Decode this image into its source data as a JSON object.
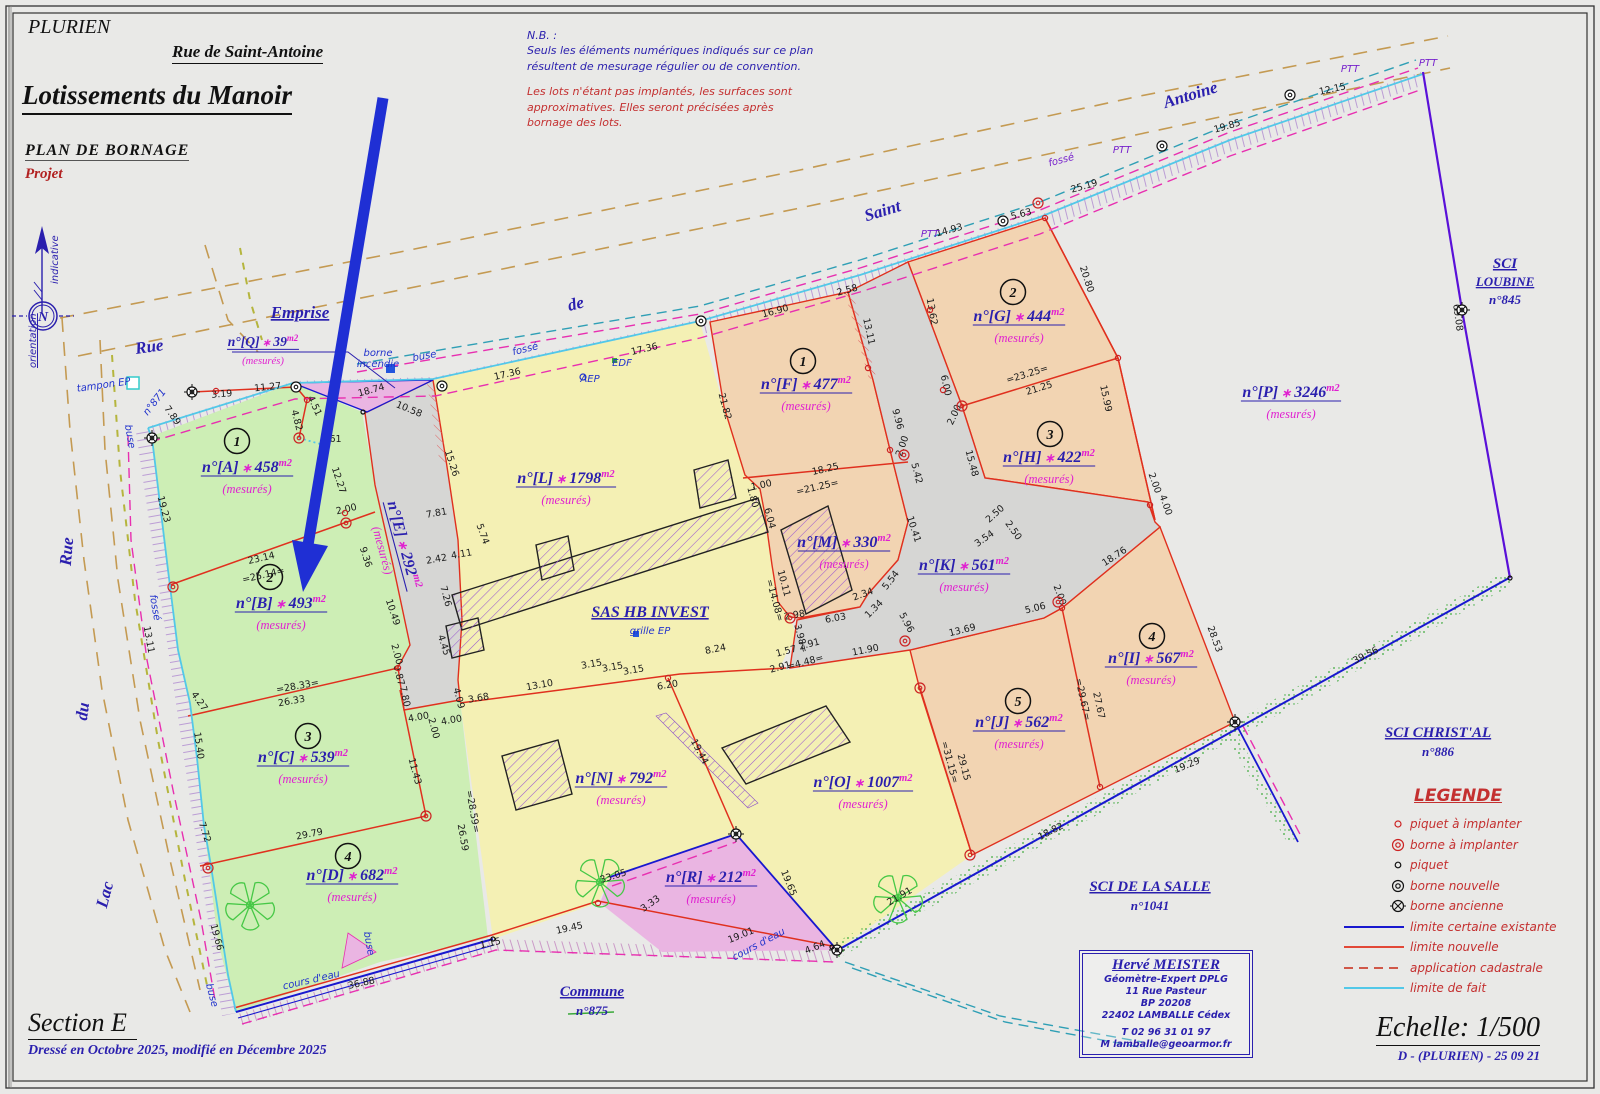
{
  "header": {
    "commune": "PLURIEN",
    "street_title": "Rue de Saint-Antoine",
    "title": "Lotissements du Manoir",
    "subtitle": "PLAN DE BORNAGE",
    "status": "Projet"
  },
  "notes": {
    "heading": "N.B. :",
    "blue": [
      "Seuls les éléments numériques indiqués sur ce plan",
      "résultent de mesurage régulier ou de convention."
    ],
    "red": [
      "Les lots n'étant pas implantés, les surfaces sont",
      "approximatives. Elles seront précisées après",
      "bornage des lots."
    ]
  },
  "north": {
    "n": "N",
    "indicative": "indicative",
    "orientation": "orientation"
  },
  "footer": {
    "section": "Section E",
    "drafted": "Dressé en Octobre 2025, modifié en Décembre 2025",
    "scale": "Echelle: 1/500",
    "ref": "D - (PLURIEN) - 25 09 21"
  },
  "surveyor": {
    "name": "Hervé MEISTER",
    "lines": [
      "Géomètre-Expert DPLG",
      "11 Rue Pasteur",
      "BP 20208",
      "22402 LAMBALLE Cédex",
      "T 02 96 31 01 97",
      "M lamballe@geoarmor.fr"
    ]
  },
  "legend": {
    "title": "LEGENDE",
    "items": [
      {
        "symbol": "piquet-a-implanter",
        "label": "piquet à implanter"
      },
      {
        "symbol": "borne-a-implanter",
        "label": "borne à implanter"
      },
      {
        "symbol": "piquet",
        "label": "piquet"
      },
      {
        "symbol": "borne-nouvelle",
        "label": "borne nouvelle"
      },
      {
        "symbol": "borne-ancienne",
        "label": "borne ancienne"
      },
      {
        "symbol": "limite-certaine-existante",
        "label": "limite certaine existante"
      },
      {
        "symbol": "limite-nouvelle",
        "label": "limite nouvelle"
      },
      {
        "symbol": "application-cadastrale",
        "label": "application cadastrale"
      },
      {
        "symbol": "limite-de-fait",
        "label": "limite de fait"
      }
    ]
  },
  "colors": {
    "accent_blue": "#2a1fae",
    "magenta": "#e020d0",
    "red_line": "#e0301e",
    "blue_line": "#1818cf",
    "cyan_line": "#52c8e8",
    "purple_line": "#5a10d8",
    "green_parcel": "#cdeeb5",
    "yellow_parcel": "#f4f0b4",
    "orange_parcel": "#f2d4b2",
    "pink_parcel": "#eab5e2",
    "road_gray": "#d6d6d4",
    "legend_red": "#c43030",
    "arrow_blue": "#1f2fd4"
  },
  "parcels": [
    {
      "id": "A",
      "name": "n°[A]",
      "area": "458",
      "unit": "m2",
      "note": "(mesurés)",
      "lot": "1",
      "x": 247,
      "y": 472,
      "lot_x": 237,
      "lot_y": 441
    },
    {
      "id": "B",
      "name": "n°[B]",
      "area": "493",
      "unit": "m2",
      "note": "(mesurés)",
      "lot": "2",
      "x": 281,
      "y": 608,
      "lot_x": 270,
      "lot_y": 577
    },
    {
      "id": "C",
      "name": "n°[C]",
      "area": "539",
      "unit": "m2",
      "note": "(mesurés)",
      "lot": "3",
      "x": 303,
      "y": 762,
      "lot_x": 308,
      "lot_y": 736
    },
    {
      "id": "D",
      "name": "n°[D]",
      "area": "682",
      "unit": "m2",
      "note": "(mesurés)",
      "lot": "4",
      "x": 352,
      "y": 880,
      "lot_x": 348,
      "lot_y": 856
    },
    {
      "id": "E",
      "name": "n°[E]",
      "area": "292",
      "unit": "m2",
      "note": "(mesurés)",
      "x": 399,
      "y": 546,
      "angle": 75
    },
    {
      "id": "F",
      "name": "n°[F]",
      "area": "477",
      "unit": "m2",
      "note": "(mesurés)",
      "lot": "1",
      "x": 806,
      "y": 389,
      "lot_x": 803,
      "lot_y": 361
    },
    {
      "id": "G",
      "name": "n°[G]",
      "area": "444",
      "unit": "m2",
      "note": "(mesurés)",
      "lot": "2",
      "x": 1019,
      "y": 321,
      "lot_x": 1013,
      "lot_y": 292
    },
    {
      "id": "H",
      "name": "n°[H]",
      "area": "422",
      "unit": "m2",
      "note": "(mesurés)",
      "lot": "3",
      "x": 1049,
      "y": 462,
      "lot_x": 1050,
      "lot_y": 434
    },
    {
      "id": "I",
      "name": "n°[I]",
      "area": "567",
      "unit": "m2",
      "note": "(mesurés)",
      "lot": "4",
      "x": 1151,
      "y": 663,
      "lot_x": 1152,
      "lot_y": 636
    },
    {
      "id": "J",
      "name": "n°[J]",
      "area": "562",
      "unit": "m2",
      "note": "(mesurés)",
      "lot": "5",
      "x": 1019,
      "y": 727,
      "lot_x": 1018,
      "lot_y": 701
    },
    {
      "id": "K",
      "name": "n°[K]",
      "area": "561",
      "unit": "m2",
      "note": "(mesurés)",
      "x": 964,
      "y": 570
    },
    {
      "id": "L",
      "name": "n°[L]",
      "area": "1798",
      "unit": "m2",
      "note": "(mesurés)",
      "x": 566,
      "y": 483
    },
    {
      "id": "M",
      "name": "n°[M]",
      "area": "330",
      "unit": "m2",
      "note": "(mesurés)",
      "x": 844,
      "y": 547
    },
    {
      "id": "N",
      "name": "n°[N]",
      "area": "792",
      "unit": "m2",
      "note": "(mesurés)",
      "x": 621,
      "y": 783
    },
    {
      "id": "O",
      "name": "n°[O]",
      "area": "1007",
      "unit": "m2",
      "note": "(mesurés)",
      "x": 863,
      "y": 787
    },
    {
      "id": "P",
      "name": "n°[P]",
      "area": "3246",
      "unit": "m2",
      "note": "(mesurés)",
      "x": 1291,
      "y": 397
    },
    {
      "id": "Q",
      "name": "n°[Q]",
      "area": "39",
      "unit": "m2",
      "note": "(mesurés)",
      "x": 263,
      "y": 346,
      "s": 0.85
    },
    {
      "id": "R",
      "name": "n°[R]",
      "area": "212",
      "unit": "m2",
      "note": "(mesurés)",
      "x": 711,
      "y": 882
    }
  ],
  "owners": [
    {
      "x": 1505,
      "y": 268,
      "fs": 15,
      "lh": 18,
      "lines": [
        [
          "SCI",
          1
        ],
        [
          "LOUBINE",
          1
        ],
        [
          "n°845",
          0
        ]
      ]
    },
    {
      "x": 1438,
      "y": 737,
      "fs": 15,
      "lh": 19,
      "lines": [
        [
          "SCI CHRIST'AL",
          1
        ],
        [
          "n°886",
          0
        ]
      ]
    },
    {
      "x": 1150,
      "y": 891,
      "fs": 15,
      "lh": 19,
      "lines": [
        [
          "SCI DE LA SALLE",
          1
        ],
        [
          "n°1041",
          0
        ]
      ]
    },
    {
      "x": 592,
      "y": 996,
      "fs": 15,
      "lh": 19,
      "lines": [
        [
          "Commune",
          1
        ],
        [
          "n°875",
          0
        ]
      ]
    },
    {
      "x": 650,
      "y": 617,
      "fs": 16,
      "lh": 19,
      "lines": [
        [
          "SAS HB INVEST",
          1
        ]
      ]
    }
  ],
  "streets": [
    {
      "t": "Rue",
      "x": 150,
      "y": 352,
      "a": -8
    },
    {
      "t": "de",
      "x": 577,
      "y": 309,
      "a": -14
    },
    {
      "t": "Saint",
      "x": 884,
      "y": 216,
      "a": -17
    },
    {
      "t": "Antoine",
      "x": 1192,
      "y": 100,
      "a": -17
    },
    {
      "t": "Rue",
      "x": 72,
      "y": 552,
      "a": -85
    },
    {
      "t": "du",
      "x": 88,
      "y": 712,
      "a": -83
    },
    {
      "t": "Lac",
      "x": 110,
      "y": 896,
      "a": -75
    },
    {
      "t": "Emprise",
      "x": 300,
      "y": 318,
      "a": 0,
      "u": 1
    }
  ],
  "utilities": [
    {
      "t": "borne",
      "x": 378,
      "y": 356,
      "a": 0,
      "c": "b"
    },
    {
      "t": "incendie",
      "x": 378,
      "y": 367,
      "a": 0,
      "c": "b"
    },
    {
      "t": "buse",
      "x": 425,
      "y": 359,
      "a": -10,
      "c": "b"
    },
    {
      "t": "fossé",
      "x": 526,
      "y": 352,
      "a": -14,
      "c": "b"
    },
    {
      "t": "AEP",
      "x": 590,
      "y": 382,
      "a": 0,
      "c": "b"
    },
    {
      "t": "EDF",
      "x": 622,
      "y": 366,
      "a": 0,
      "c": "b"
    },
    {
      "t": "tampon EP",
      "x": 104,
      "y": 388,
      "a": -8,
      "c": "b"
    },
    {
      "t": "buse",
      "x": 127,
      "y": 437,
      "a": 80,
      "c": "b"
    },
    {
      "t": "fossé",
      "x": 152,
      "y": 608,
      "a": 80,
      "c": "b"
    },
    {
      "t": "buse",
      "x": 209,
      "y": 996,
      "a": 75,
      "c": "b"
    },
    {
      "t": "buse",
      "x": 366,
      "y": 944,
      "a": 80,
      "c": "b"
    },
    {
      "t": "grille EP",
      "x": 650,
      "y": 634,
      "a": 0,
      "c": "b"
    },
    {
      "t": "cours d'eau",
      "x": 312,
      "y": 983,
      "a": -13,
      "c": "b"
    },
    {
      "t": "cours d'eau",
      "x": 760,
      "y": 947,
      "a": -28,
      "c": "b"
    },
    {
      "t": "fossé",
      "x": 1062,
      "y": 163,
      "a": -15,
      "c": "p"
    },
    {
      "t": "PTT",
      "x": 930,
      "y": 237,
      "a": 0,
      "c": "p"
    },
    {
      "t": "PTT",
      "x": 1122,
      "y": 153,
      "a": 0,
      "c": "p"
    },
    {
      "t": "PTT",
      "x": 1350,
      "y": 72,
      "a": 0,
      "c": "p"
    },
    {
      "t": "PTT",
      "x": 1428,
      "y": 66,
      "a": 0,
      "c": "p"
    },
    {
      "t": "n°871",
      "x": 157,
      "y": 404,
      "a": -52,
      "c": "b"
    }
  ],
  "measurements": [
    [
      "18.74",
      372,
      393,
      -15
    ],
    [
      "10.58",
      408,
      412,
      22
    ],
    [
      "17.36",
      508,
      377,
      -13
    ],
    [
      "17.36",
      645,
      352,
      -13
    ],
    [
      "14.93",
      950,
      233,
      -15
    ],
    [
      "5.63",
      1022,
      217,
      -15
    ],
    [
      "25.19",
      1085,
      189,
      -16
    ],
    [
      "19.85",
      1228,
      129,
      -16
    ],
    [
      "12.15",
      1333,
      92,
      -12
    ],
    [
      "69.08",
      1455,
      318,
      82
    ],
    [
      "3.19",
      222,
      397,
      -5
    ],
    [
      "11.27",
      268,
      390,
      -6
    ],
    [
      "4.51",
      312,
      407,
      65
    ],
    [
      "4.82",
      294,
      421,
      75
    ],
    [
      "3.61",
      331,
      442,
      0
    ],
    [
      "7.89",
      170,
      417,
      55
    ],
    [
      "19.23",
      161,
      510,
      75
    ],
    [
      "12.27",
      336,
      481,
      72
    ],
    [
      "15.26",
      449,
      464,
      72
    ],
    [
      "23.14",
      262,
      561,
      -13
    ],
    [
      "=25.14=",
      264,
      578,
      -13
    ],
    [
      "2.00",
      347,
      512,
      -13
    ],
    [
      "9.36",
      363,
      558,
      72
    ],
    [
      "13.11",
      146,
      640,
      80
    ],
    [
      "10.49",
      390,
      613,
      72
    ],
    [
      "2.00",
      394,
      655,
      75
    ],
    [
      "0.87",
      396,
      676,
      75
    ],
    [
      "=28.33=",
      298,
      689,
      -10
    ],
    [
      "26.33",
      292,
      704,
      -10
    ],
    [
      "4.27",
      197,
      703,
      55
    ],
    [
      "15.40",
      196,
      746,
      82
    ],
    [
      "7.80",
      402,
      697,
      78
    ],
    [
      "11.43",
      412,
      772,
      75
    ],
    [
      "2.00",
      431,
      729,
      75
    ],
    [
      "4.00",
      419,
      720,
      -10
    ],
    [
      "4.00",
      452,
      723,
      -10
    ],
    [
      "4.09",
      456,
      699,
      75
    ],
    [
      "3.68",
      479,
      701,
      -10
    ],
    [
      "13.10",
      540,
      688,
      -10
    ],
    [
      "7.72",
      202,
      833,
      72
    ],
    [
      "29.79",
      310,
      837,
      -11
    ],
    [
      "=28.59=",
      470,
      812,
      80
    ],
    [
      "26.59",
      460,
      838,
      80
    ],
    [
      "19.66",
      214,
      938,
      75
    ],
    [
      "36.88",
      362,
      986,
      -12
    ],
    [
      "1.15",
      491,
      946,
      -12
    ],
    [
      "33.05",
      614,
      879,
      -17
    ],
    [
      "3.33",
      652,
      906,
      -35
    ],
    [
      "19.45",
      570,
      931,
      -12
    ],
    [
      "19.01",
      742,
      938,
      -22
    ],
    [
      "7.81",
      437,
      516,
      -10
    ],
    [
      "5.74",
      480,
      535,
      70
    ],
    [
      "2.42",
      437,
      562,
      -10
    ],
    [
      "4.11",
      462,
      557,
      -10
    ],
    [
      "7.26",
      443,
      597,
      75
    ],
    [
      "4.45",
      441,
      646,
      72
    ],
    [
      "21.82",
      722,
      407,
      75
    ],
    [
      "1.00",
      762,
      488,
      -12
    ],
    [
      "1.80",
      750,
      498,
      75
    ],
    [
      "6.04",
      767,
      519,
      75
    ],
    [
      "10.11",
      781,
      584,
      75
    ],
    [
      "=14.08=",
      772,
      601,
      75
    ],
    [
      "2.98",
      795,
      618,
      -10
    ],
    [
      "6.03",
      836,
      621,
      -10
    ],
    [
      "2.34",
      864,
      597,
      -20
    ],
    [
      "1.34",
      876,
      611,
      -45
    ],
    [
      "5.54",
      893,
      582,
      -52
    ],
    [
      "5.96",
      904,
      624,
      62
    ],
    [
      "3.98=",
      798,
      639,
      75
    ],
    [
      "1.57",
      787,
      654,
      -15
    ],
    [
      "2.91",
      810,
      647,
      -15
    ],
    [
      "=4.48=",
      806,
      665,
      -15
    ],
    [
      "2.91",
      781,
      670,
      -15
    ],
    [
      "11.90",
      866,
      653,
      -11
    ],
    [
      "8.24",
      716,
      652,
      -11
    ],
    [
      "3.15",
      592,
      667,
      -10
    ],
    [
      "3.15",
      613,
      670,
      -10
    ],
    [
      "3.15",
      634,
      673,
      -10
    ],
    [
      "6.20",
      668,
      688,
      -10
    ],
    [
      "16.90",
      776,
      314,
      -15
    ],
    [
      "2.58",
      848,
      293,
      -15
    ],
    [
      "13.11",
      866,
      332,
      78
    ],
    [
      "13.62",
      929,
      312,
      80
    ],
    [
      "9.96",
      895,
      420,
      75
    ],
    [
      "2.00",
      905,
      447,
      -70
    ],
    [
      "18.25",
      826,
      472,
      -13
    ],
    [
      "=21.25=",
      818,
      490,
      -13
    ],
    [
      "5.42",
      914,
      474,
      75
    ],
    [
      "15.48",
      969,
      464,
      75
    ],
    [
      "6.00",
      943,
      386,
      78
    ],
    [
      "20.80",
      1084,
      280,
      72
    ],
    [
      "=23.25=",
      1028,
      377,
      -17
    ],
    [
      "21.25",
      1040,
      391,
      -17
    ],
    [
      "2.00",
      957,
      416,
      -65
    ],
    [
      "15.99",
      1103,
      399,
      78
    ],
    [
      "2.00",
      1152,
      484,
      70
    ],
    [
      "4.00",
      1163,
      506,
      70
    ],
    [
      "2.50",
      997,
      516,
      -42
    ],
    [
      "2.50",
      1011,
      532,
      55
    ],
    [
      "3.54",
      986,
      541,
      -35
    ],
    [
      "10.41",
      911,
      530,
      72
    ],
    [
      "18.76",
      1116,
      559,
      -33
    ],
    [
      "13.69",
      963,
      633,
      -14
    ],
    [
      "5.06",
      1036,
      611,
      -14
    ],
    [
      "2.00",
      1057,
      596,
      70
    ],
    [
      "28.53",
      1212,
      640,
      70
    ],
    [
      "=29.67=",
      1080,
      700,
      78
    ],
    [
      "27.67",
      1096,
      706,
      78
    ],
    [
      "19.29",
      1188,
      768,
      -22
    ],
    [
      "18.82",
      1052,
      834,
      -27
    ],
    [
      "=31.15=",
      947,
      763,
      75
    ],
    [
      "29.15",
      961,
      768,
      75
    ],
    [
      "21.91",
      901,
      899,
      -30
    ],
    [
      "19.44",
      697,
      753,
      62
    ],
    [
      "19.65",
      786,
      884,
      68
    ],
    [
      "4.64",
      816,
      950,
      -22
    ],
    [
      "39.56",
      1367,
      658,
      -27
    ]
  ],
  "symbols": [
    [
      "ba",
      152,
      438
    ],
    [
      "ba",
      192,
      392
    ],
    [
      "ba",
      736,
      834
    ],
    [
      "ba",
      837,
      950
    ],
    [
      "ba",
      1235,
      722
    ],
    [
      "ba",
      1462,
      310
    ],
    [
      "bn",
      296,
      387
    ],
    [
      "bn",
      442,
      386
    ],
    [
      "bn",
      701,
      321
    ],
    [
      "bn",
      1003,
      221
    ],
    [
      "bn",
      1162,
      146
    ],
    [
      "bn",
      1290,
      95
    ],
    [
      "bi",
      299,
      438
    ],
    [
      "bi",
      173,
      587
    ],
    [
      "bi",
      346,
      523
    ],
    [
      "bi",
      426,
      816
    ],
    [
      "bi",
      904,
      455
    ],
    [
      "bi",
      962,
      406
    ],
    [
      "bi",
      1058,
      602
    ],
    [
      "bi",
      920,
      688
    ],
    [
      "bi",
      905,
      641
    ],
    [
      "bi",
      970,
      855
    ],
    [
      "bi",
      1038,
      203
    ],
    [
      "bi",
      208,
      868
    ],
    [
      "bi",
      790,
      618
    ],
    [
      "pi",
      216,
      391
    ],
    [
      "pi",
      307,
      400
    ],
    [
      "pi",
      345,
      513
    ],
    [
      "pi",
      398,
      668
    ],
    [
      "pi",
      868,
      368
    ],
    [
      "pi",
      930,
      310
    ],
    [
      "pi",
      943,
      390
    ],
    [
      "pi",
      890,
      450
    ],
    [
      "pi",
      1045,
      218
    ],
    [
      "pi",
      1118,
      358
    ],
    [
      "pi",
      1150,
      505
    ],
    [
      "pi",
      1062,
      608
    ],
    [
      "pi",
      1100,
      787
    ],
    [
      "pi",
      668,
      678
    ],
    [
      "pi",
      598,
      903
    ],
    [
      "pq",
      363,
      412
    ],
    [
      "pq",
      493,
      939
    ],
    [
      "pq",
      1510,
      578
    ],
    [
      "pq",
      832,
      947
    ]
  ]
}
